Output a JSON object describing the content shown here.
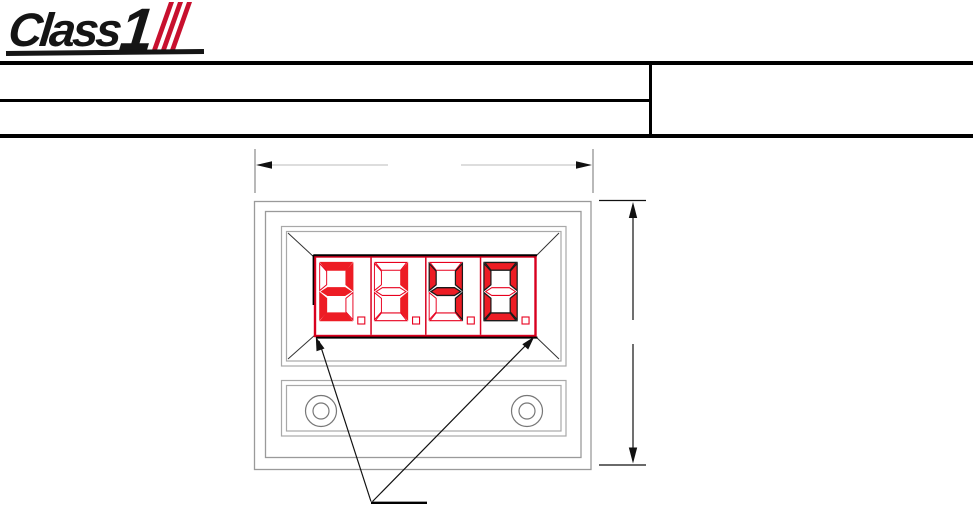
{
  "logo": {
    "word": "Class",
    "numeral": "1",
    "stripe_count": 3,
    "stripe_color": "#c8102e",
    "ink_color": "#151515"
  },
  "title_block": {
    "left_row_count": 2,
    "right_row_count": 1,
    "cells_text": [
      "",
      "",
      ""
    ]
  },
  "drawing": {
    "type": "dimensioned panel-meter front view",
    "display": {
      "value": "2140",
      "digits": [
        "2",
        "1",
        "4",
        "0"
      ],
      "decimal_points_lit": [
        false,
        false,
        false,
        false
      ],
      "lit_color": "#ed1c24",
      "unlit_outline_color": "#e8001e",
      "bezel_color": "#d8001e"
    },
    "figure_colors": {
      "panel_outline": "#9a9a9a",
      "recess_outline": "#a8a8a8",
      "screw_outline": "#777777",
      "dim_line_gray": "#d2d2d2",
      "ext_line_gray": "#8a8a8a",
      "ink_black": "#111111"
    },
    "dimension_labels": {
      "width_label": "",
      "height_label": "",
      "leader_label": ""
    }
  }
}
